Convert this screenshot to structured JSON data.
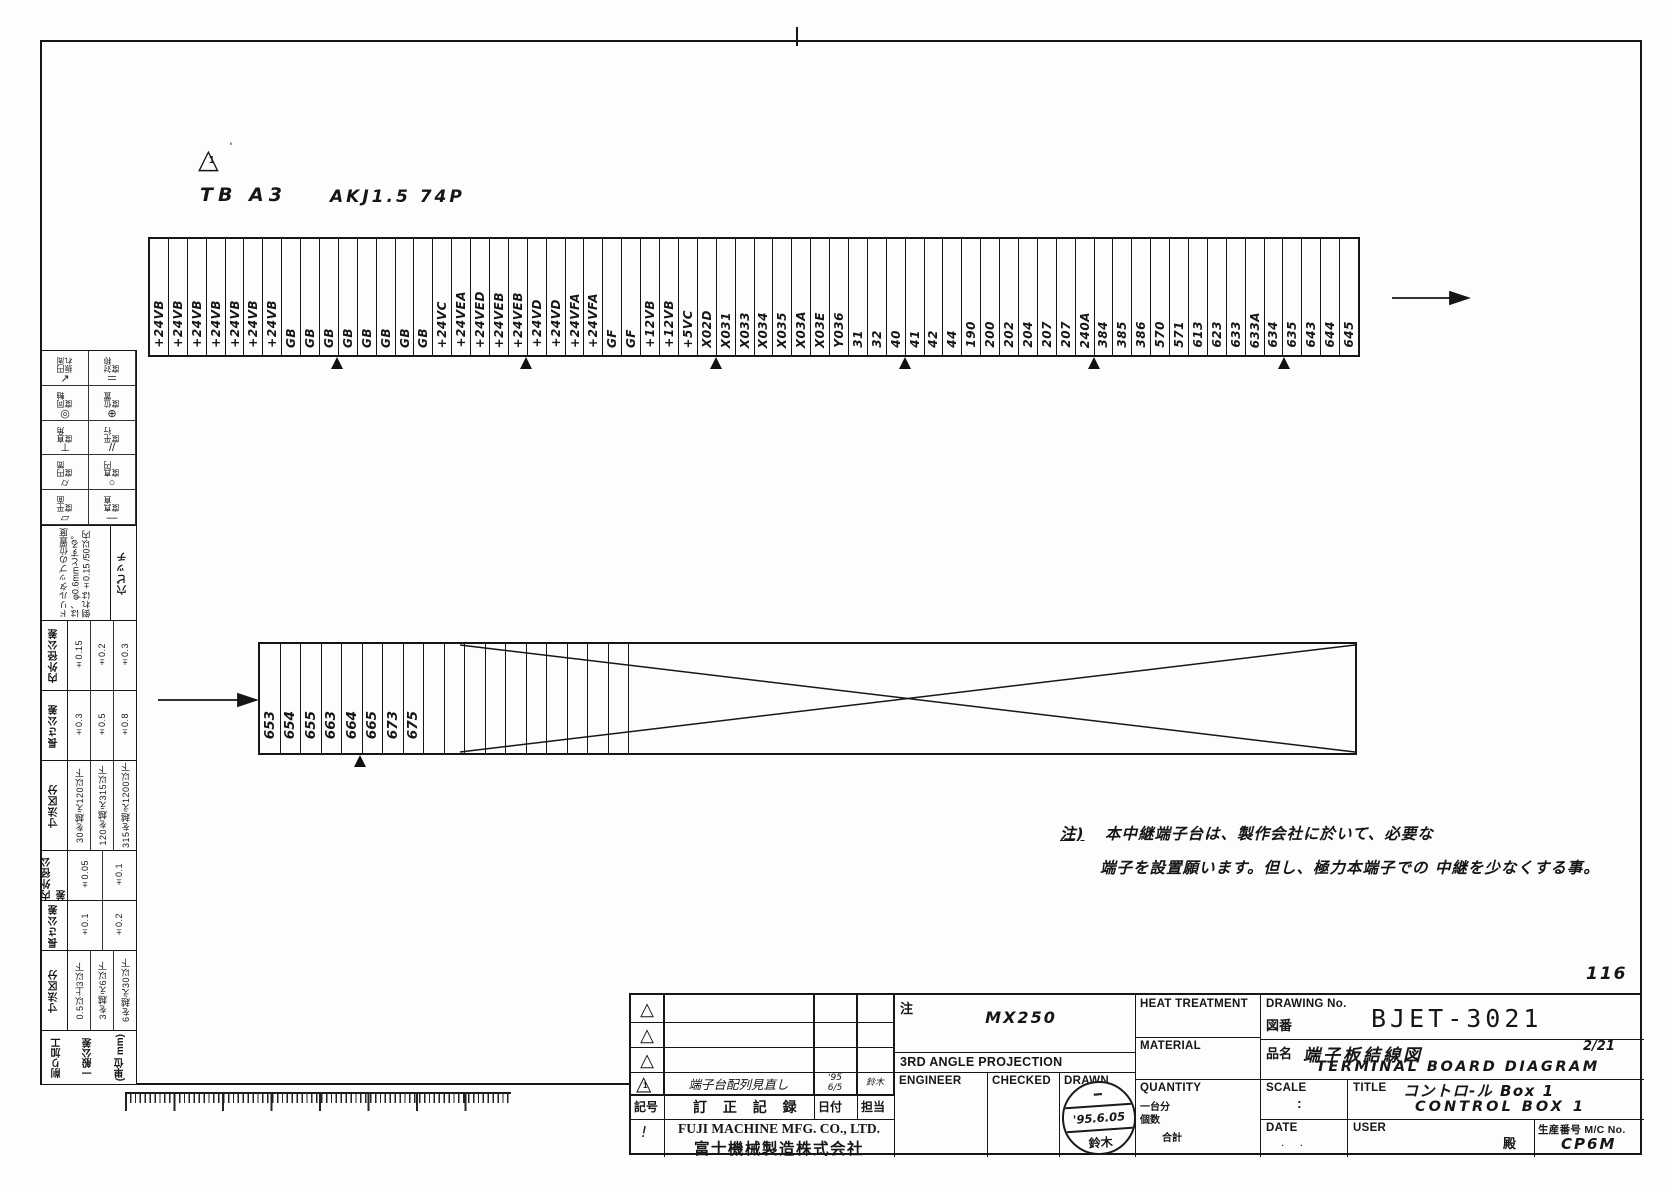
{
  "sheet": {
    "page_no": "116"
  },
  "drawing_header": {
    "revision_mark_symbol": "△",
    "revision_mark_num": "1",
    "revision_mark_prime": "'",
    "board_label": "TB A3",
    "spec_label": "AKJ1.5 74P"
  },
  "top_strip": {
    "labels": [
      "+24VB",
      "+24VB",
      "+24VB",
      "+24VB",
      "+24VB",
      "+24VB",
      "+24VB",
      "GB",
      "GB",
      "GB",
      "GB",
      "GB",
      "GB",
      "GB",
      "GB",
      "+24VC",
      "+24VEA",
      "+24VED",
      "+24VEB",
      "+24VEB",
      "+24VD",
      "+24VD",
      "+24VFA",
      "+24VFA",
      "GF",
      "GF",
      "+12VB",
      "+12VB",
      "+5VC",
      "X02D",
      "X031",
      "X033",
      "X034",
      "X035",
      "X03A",
      "X03E",
      "Y036",
      "31",
      "32",
      "40",
      "41",
      "42",
      "44",
      "190",
      "200",
      "202",
      "204",
      "207",
      "207",
      "240A",
      "384",
      "385",
      "386",
      "570",
      "571",
      "613",
      "623",
      "633",
      "633A",
      "634",
      "635",
      "643",
      "644",
      "645"
    ],
    "marker_after": [
      10,
      20,
      30,
      40,
      50,
      60
    ]
  },
  "bottom_strip": {
    "labels": [
      "653",
      "654",
      "655",
      "663",
      "664",
      "665",
      "673",
      "675"
    ],
    "marker_after": [
      5
    ]
  },
  "note": {
    "prefix": "注)",
    "line1": "本中継端子台は、製作会社に於いて、必要な",
    "line2": "端子を設置願います。但し、極力本端子での 中継を少なくする事。"
  },
  "sidebar": {
    "symbol_columns": {
      "left": [
        {
          "label": "円周振れ",
          "symbol": "↗"
        },
        {
          "label": "同軸度",
          "symbol": "◎"
        },
        {
          "label": "直角度",
          "symbol": "⊥"
        },
        {
          "label": "円筒度",
          "symbol": "⌭"
        },
        {
          "label": "平面度",
          "symbol": "▱"
        }
      ],
      "right": [
        {
          "label": "対称度",
          "symbol": "＝"
        },
        {
          "label": "位置度",
          "symbol": "⊕"
        },
        {
          "label": "平行度",
          "symbol": "//"
        },
        {
          "label": "真円度",
          "symbol": "○"
        },
        {
          "label": "真直度",
          "symbol": "—"
        }
      ]
    },
    "hole_pitch": {
      "header": "穴ピッチ",
      "note": "ドリルタップの位置度は、φ0.6mmとする。倒れは±0.15 /50以内"
    },
    "tables": [
      {
        "header": "内外径公差",
        "values": [
          "±0.15",
          "±0.2",
          "±0.3"
        ]
      },
      {
        "header": "長さ公差",
        "values": [
          "±0.3",
          "±0.5",
          "±0.8"
        ]
      },
      {
        "header": "寸法区分",
        "values": [
          "30を越え120以下",
          "120を越え315以下",
          "315を越え1200以下"
        ]
      },
      {
        "header": "内外径公差",
        "values": [
          "±0.05",
          "±0.1"
        ]
      },
      {
        "header": "長さ公差",
        "values": [
          "±0.1",
          "±0.2"
        ]
      },
      {
        "header": "寸法区分",
        "values": [
          "0.5以上3以下",
          "3を越え6以下",
          "6を越え30以下"
        ]
      }
    ],
    "footer": {
      "line1": "削り加工",
      "line2": "一般公差",
      "line3": "(単位 mm)"
    }
  },
  "title_block": {
    "revision_table": {
      "rows": [
        {
          "mark": "△",
          "description": "",
          "date": "",
          "by": ""
        },
        {
          "mark": "△",
          "description": "",
          "date": "",
          "by": ""
        },
        {
          "mark": "△",
          "description": "",
          "date": "",
          "by": ""
        },
        {
          "mark": "△",
          "mark_num": "1",
          "mark_prime": "'",
          "description": "端子台配列見直し",
          "date": "'95 6/5",
          "by": "鈴木"
        }
      ],
      "header": {
        "mark": "記号",
        "description": "訂 正 記 録",
        "date": "日付",
        "by": "担当"
      },
      "footer_mark": "!",
      "company_en": "FUJI MACHINE MFG. CO., LTD.",
      "company_jp": "富士機械製造株式会社"
    },
    "center": {
      "note_label": "注",
      "note_value": "MX250",
      "projection": "3RD ANGLE PROJECTION",
      "engineer_label": "ENGINEER",
      "checked_label": "CHECKED",
      "drawn_label": "DRAWN",
      "stamp": {
        "dept": "▪▪▪▪",
        "date": "'95.6.05",
        "name": "鈴木"
      }
    },
    "spec": {
      "heat_label": "HEAT TREATMENT",
      "material_label": "MATERIAL",
      "quantity_label": "QUANTITY",
      "qty_line1": "一台分",
      "qty_line2": "個数",
      "qty_line3": "合計"
    },
    "info": {
      "drawing_no_label": "DRAWING No.",
      "zuban_label": "図番",
      "drawing_no": "BJET-3021",
      "hinmei_label": "品名",
      "product_jp": "端子板結線図",
      "page_fraction": "2/21",
      "product_en": "TERMINAL BOARD DIAGRAM",
      "scale_label": "SCALE",
      "scale_value": ":",
      "title_label": "TITLE",
      "title_jp": "コントロ-ル Box 1",
      "title_en": "CONTROL BOX 1",
      "date_label": "DATE",
      "date_value": ".      .",
      "user_label": "USER",
      "user_honorific": "殿",
      "serial_label": "生産番号 M/C No.",
      "serial_value": "CP6M"
    }
  }
}
